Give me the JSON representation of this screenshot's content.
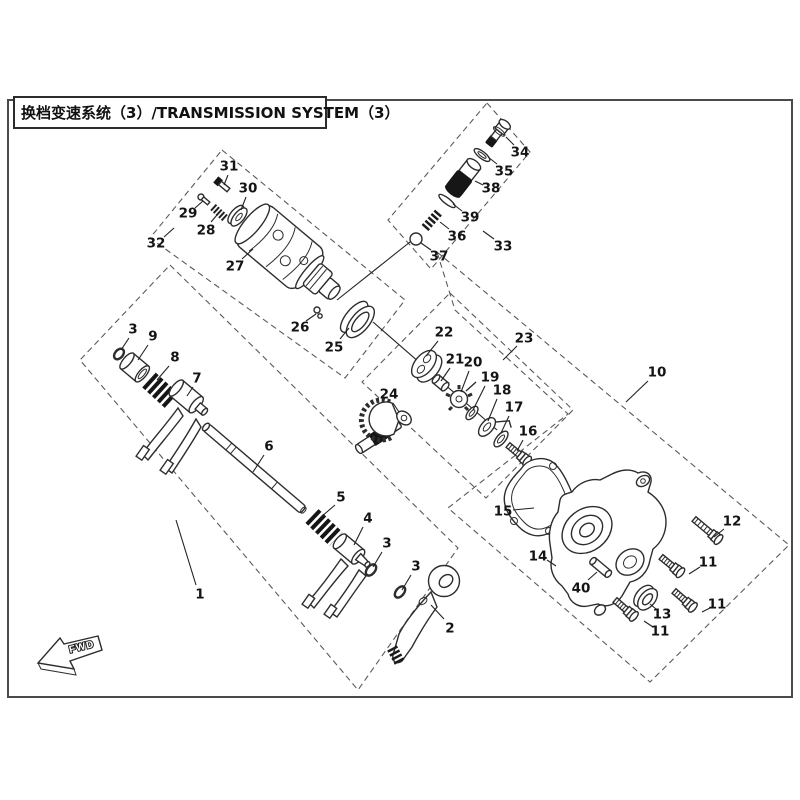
{
  "title": "换档变速系统（3）/TRANSMISSION SYSTEM（3）",
  "direction_label": "FWD",
  "colors": {
    "line": "#2d2d2d",
    "background": "#ffffff",
    "dashed_box": "#5a5a5a"
  },
  "callouts": [
    {
      "t": "1",
      "x": 200,
      "y": 594,
      "x1": 176,
      "y1": 520,
      "x2": 196,
      "y2": 585
    },
    {
      "t": "2",
      "x": 450,
      "y": 628,
      "x1": 431,
      "y1": 605,
      "x2": 444,
      "y2": 619
    },
    {
      "t": "3",
      "x": 133,
      "y": 329,
      "x1": 121,
      "y1": 350,
      "x2": 129,
      "y2": 338
    },
    {
      "t": "9",
      "x": 153,
      "y": 336,
      "x1": 138,
      "y1": 360,
      "x2": 148,
      "y2": 345
    },
    {
      "t": "8",
      "x": 175,
      "y": 357,
      "x1": 157,
      "y1": 380,
      "x2": 169,
      "y2": 366
    },
    {
      "t": "7",
      "x": 197,
      "y": 378,
      "x1": 187,
      "y1": 396,
      "x2": 193,
      "y2": 387
    },
    {
      "t": "6",
      "x": 269,
      "y": 446,
      "x1": 253,
      "y1": 472,
      "x2": 264,
      "y2": 455
    },
    {
      "t": "5",
      "x": 341,
      "y": 497,
      "x1": 321,
      "y1": 517,
      "x2": 335,
      "y2": 505
    },
    {
      "t": "4",
      "x": 368,
      "y": 518,
      "x1": 354,
      "y1": 545,
      "x2": 363,
      "y2": 527
    },
    {
      "t": "3",
      "x": 387,
      "y": 543,
      "x1": 373,
      "y1": 567,
      "x2": 382,
      "y2": 552
    },
    {
      "t": "3",
      "x": 416,
      "y": 566,
      "x1": 402,
      "y1": 590,
      "x2": 411,
      "y2": 575
    },
    {
      "t": "31",
      "x": 229,
      "y": 166,
      "x1": 224,
      "y1": 185,
      "x2": 228,
      "y2": 175
    },
    {
      "t": "30",
      "x": 248,
      "y": 188,
      "x1": 241,
      "y1": 210,
      "x2": 246,
      "y2": 197
    },
    {
      "t": "29",
      "x": 188,
      "y": 213,
      "x1": 203,
      "y1": 201,
      "x2": 195,
      "y2": 208
    },
    {
      "t": "28",
      "x": 206,
      "y": 230,
      "x1": 217,
      "y1": 215,
      "x2": 211,
      "y2": 222
    },
    {
      "t": "32",
      "x": 156,
      "y": 243,
      "x1": 174,
      "y1": 228,
      "x2": 164,
      "y2": 237
    },
    {
      "t": "27",
      "x": 235,
      "y": 266,
      "x1": 253,
      "y1": 249,
      "x2": 242,
      "y2": 259
    },
    {
      "t": "26",
      "x": 300,
      "y": 327,
      "x1": 316,
      "y1": 314,
      "x2": 306,
      "y2": 321
    },
    {
      "t": "25",
      "x": 334,
      "y": 347,
      "x1": 349,
      "y1": 328,
      "x2": 340,
      "y2": 339
    },
    {
      "t": "34",
      "x": 520,
      "y": 152,
      "x1": 506,
      "y1": 137,
      "x2": 514,
      "y2": 145
    },
    {
      "t": "35",
      "x": 504,
      "y": 171,
      "x1": 488,
      "y1": 157,
      "x2": 497,
      "y2": 164
    },
    {
      "t": "38",
      "x": 491,
      "y": 188,
      "x1": 475,
      "y1": 181,
      "x2": 483,
      "y2": 185
    },
    {
      "t": "39",
      "x": 470,
      "y": 217,
      "x1": 453,
      "y1": 204,
      "x2": 462,
      "y2": 211
    },
    {
      "t": "36",
      "x": 457,
      "y": 236,
      "x1": 440,
      "y1": 222,
      "x2": 449,
      "y2": 229
    },
    {
      "t": "37",
      "x": 439,
      "y": 256,
      "x1": 421,
      "y1": 243,
      "x2": 431,
      "y2": 250
    },
    {
      "t": "33",
      "x": 503,
      "y": 246,
      "x1": 483,
      "y1": 231,
      "x2": 494,
      "y2": 239
    },
    {
      "t": "22",
      "x": 444,
      "y": 332,
      "x1": 426,
      "y1": 356,
      "x2": 438,
      "y2": 341
    },
    {
      "t": "23",
      "x": 524,
      "y": 338,
      "x1": 503,
      "y1": 360,
      "x2": 517,
      "y2": 346
    },
    {
      "t": "21",
      "x": 455,
      "y": 359,
      "x1": 441,
      "y1": 381,
      "x2": 450,
      "y2": 368
    },
    {
      "t": "20",
      "x": 473,
      "y": 362,
      "x1": 461,
      "y1": 392,
      "x2": 469,
      "y2": 371
    },
    {
      "t": "19",
      "x": 490,
      "y": 377,
      "x1": 473,
      "y1": 410,
      "x2": 485,
      "y2": 386
    },
    {
      "t": "18",
      "x": 502,
      "y": 390,
      "x1": 488,
      "y1": 421,
      "x2": 497,
      "y2": 399
    },
    {
      "t": "17",
      "x": 514,
      "y": 407,
      "x1": 501,
      "y1": 433,
      "x2": 509,
      "y2": 416
    },
    {
      "t": "16",
      "x": 528,
      "y": 431,
      "x1": 517,
      "y1": 451,
      "x2": 523,
      "y2": 440
    },
    {
      "t": "24",
      "x": 389,
      "y": 394,
      "x1": 399,
      "y1": 412,
      "x2": 393,
      "y2": 403
    },
    {
      "t": "10",
      "x": 657,
      "y": 372,
      "x1": 626,
      "y1": 402,
      "x2": 648,
      "y2": 381
    },
    {
      "t": "15",
      "x": 503,
      "y": 511,
      "x1": 534,
      "y1": 508,
      "x2": 513,
      "y2": 510
    },
    {
      "t": "14",
      "x": 538,
      "y": 556,
      "x1": 556,
      "y1": 566,
      "x2": 547,
      "y2": 560
    },
    {
      "t": "40",
      "x": 581,
      "y": 588,
      "x1": 597,
      "y1": 572,
      "x2": 588,
      "y2": 580
    },
    {
      "t": "13",
      "x": 662,
      "y": 614,
      "x1": 650,
      "y1": 604,
      "x2": 656,
      "y2": 609
    },
    {
      "t": "11",
      "x": 708,
      "y": 562,
      "x1": 689,
      "y1": 574,
      "x2": 700,
      "y2": 567
    },
    {
      "t": "11",
      "x": 717,
      "y": 604,
      "x1": 702,
      "y1": 612,
      "x2": 710,
      "y2": 608
    },
    {
      "t": "11",
      "x": 660,
      "y": 631,
      "x1": 644,
      "y1": 621,
      "x2": 653,
      "y2": 627
    },
    {
      "t": "12",
      "x": 732,
      "y": 521,
      "x1": 714,
      "y1": 537,
      "x2": 724,
      "y2": 529
    }
  ],
  "group_boxes": [
    {
      "id": "1",
      "points": "170,265 458,548 358,690 80,360"
    },
    {
      "id": "32",
      "points": "222,150 405,300 345,378 150,238"
    },
    {
      "id": "33",
      "points": "487,103 530,152 431,269 388,220"
    },
    {
      "id": "23",
      "points": "450,293 573,410 486,498 362,382"
    },
    {
      "id": "10",
      "points": "437,252 789,545 650,682 448,508 568,414 455,310"
    }
  ],
  "alignment_lines": [
    [
      410,
      242,
      337,
      300
    ],
    [
      373,
      322,
      497,
      430
    ]
  ]
}
